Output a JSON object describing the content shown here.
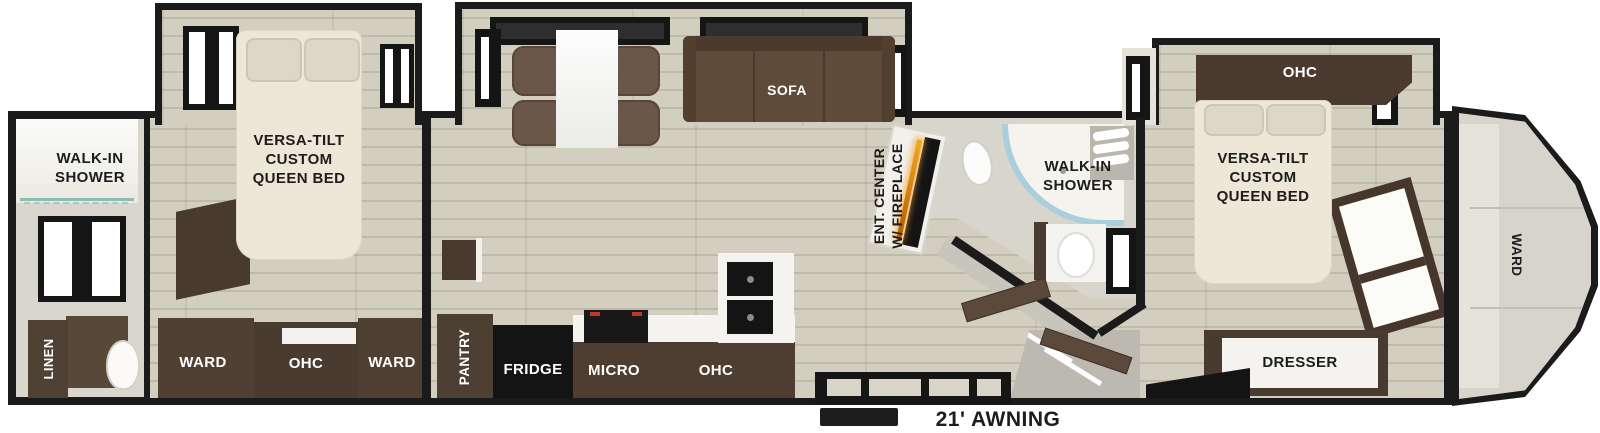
{
  "title": "Fifth-wheel RV floor plan",
  "colors": {
    "wall": "#1b1b1b",
    "floor": "#d0ccbc",
    "interior_wall": "#d9d6cd",
    "cabinet_brown": "#4e3f33",
    "bed_cream": "#ece7d6",
    "sofa_brown": "#5f4b3a",
    "appliance_black": "#141414",
    "shower_glass_blue": "#a9cfdf",
    "fireplace_orange": "#f5a623",
    "counter_white": "#f4f3ef"
  },
  "rear_bathroom": {
    "shower_label": "WALK-IN\nSHOWER",
    "linen_label": "LINEN"
  },
  "rear_bedroom": {
    "bed_label": "VERSA-TILT\nCUSTOM\nQUEEN BED",
    "ward_left_label": "WARD",
    "ohc_label": "OHC",
    "ward_right_label": "WARD"
  },
  "living_area": {
    "sofa_label": "SOFA"
  },
  "kitchen": {
    "pantry_label": "PANTRY",
    "fridge_label": "FRIDGE",
    "micro_label": "MICRO",
    "ohc_label": "OHC"
  },
  "entertainment": {
    "label": "ENT. CENTER\nW/ FIREPLACE"
  },
  "mid_bathroom": {
    "shower_label": "WALK-IN\nSHOWER"
  },
  "front_bedroom": {
    "ohc_label": "OHC",
    "bed_label": "VERSA-TILT\nCUSTOM\nQUEEN BED",
    "dresser_label": "DRESSER"
  },
  "front_cap": {
    "ward_label": "WARD"
  },
  "exterior": {
    "awning_label": "21' AWNING"
  }
}
